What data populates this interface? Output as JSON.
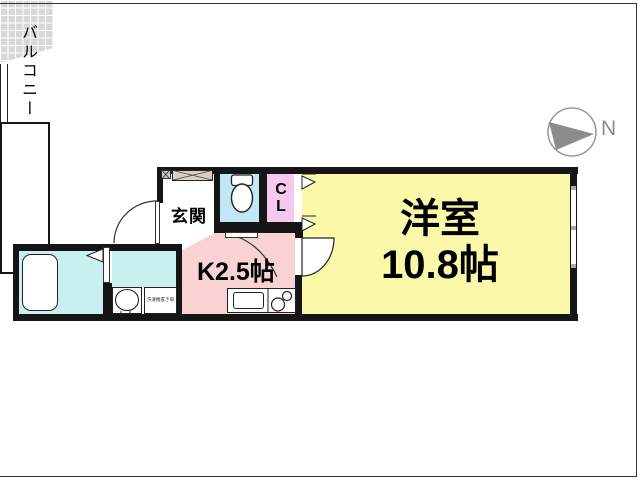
{
  "plan": {
    "type": "apartment-floorplan",
    "rooms": {
      "genkan": {
        "label": "玄関"
      },
      "closet": {
        "line1": "C",
        "line2": "L"
      },
      "kitchen": {
        "label": "K2.5帖",
        "size": "2.5帖"
      },
      "main_room": {
        "line1": "洋室",
        "line2": "10.8帖",
        "size": "10.8帖"
      },
      "balcony": {
        "label": "バルコニー"
      },
      "laundry": {
        "label": "洗濯機置き場"
      }
    },
    "compass": {
      "label": "N"
    },
    "colors": {
      "wall": "#151515",
      "main_room_fill": "#fbf9a9",
      "kitchen_fill": "#f9d3d3",
      "bath_fill": "#c9eff1",
      "toilet_fill": "#bfe7f6",
      "closet_fill": "#f5c8f0",
      "genkan_tile": "#d8d8d8",
      "shoebox_fill": "#d9d2c0",
      "compass_gray": "#8c8c8c"
    }
  }
}
